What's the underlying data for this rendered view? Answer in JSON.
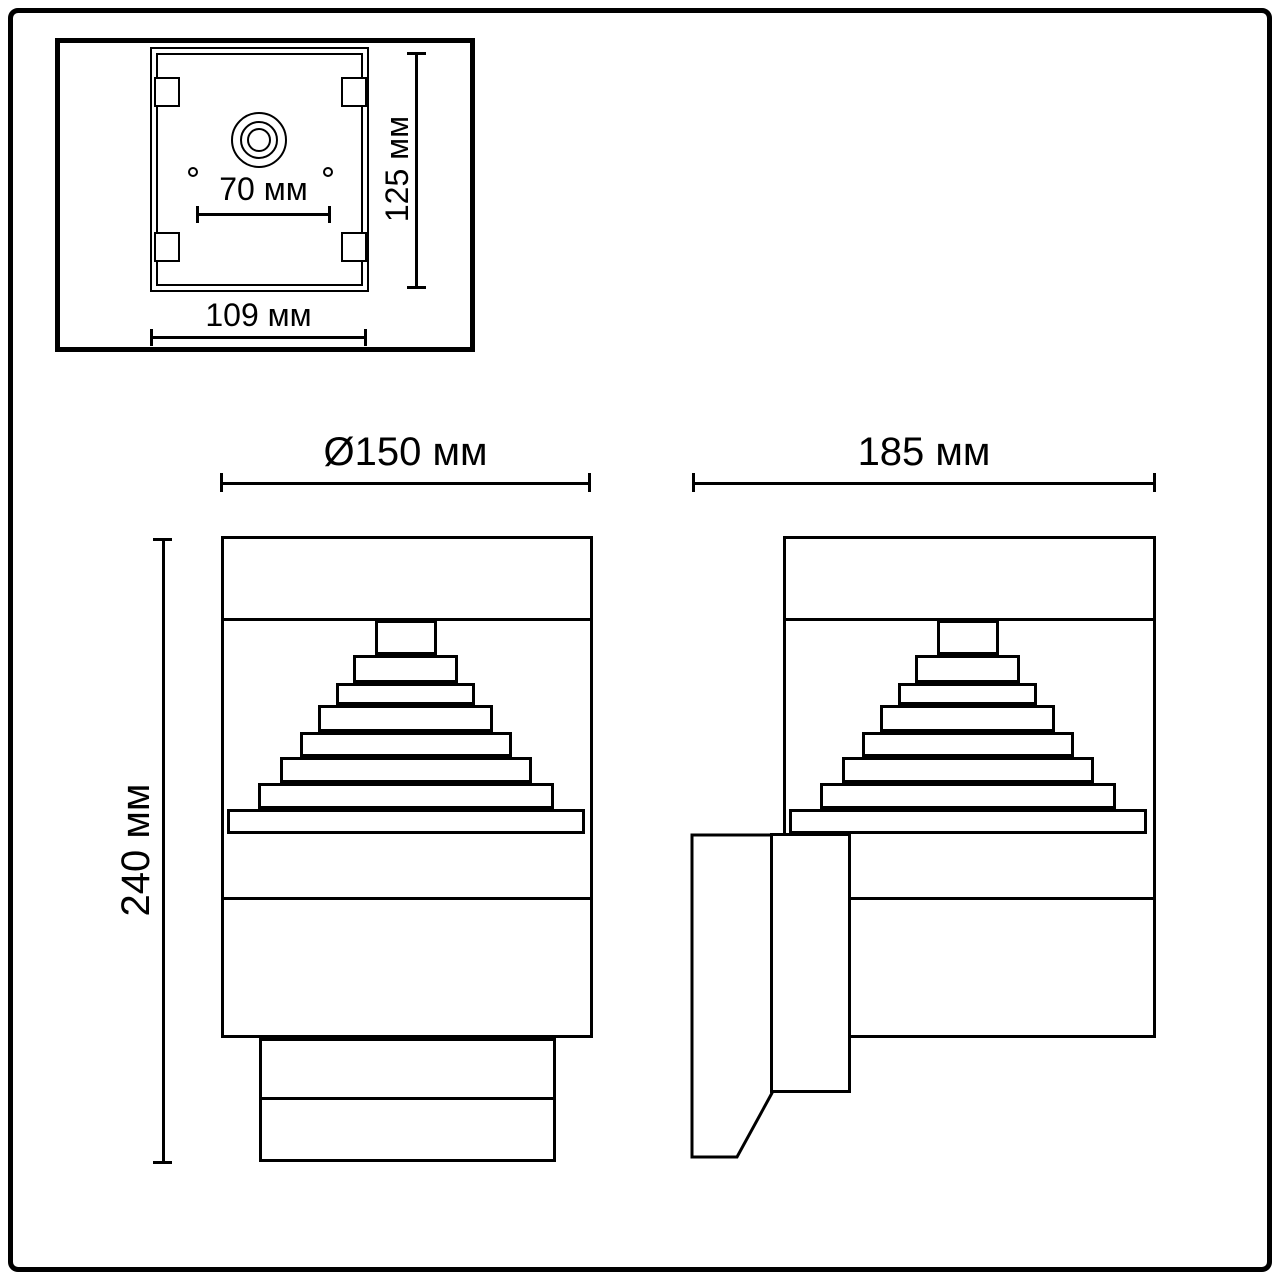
{
  "colors": {
    "background": "#ffffff",
    "line": "#000000"
  },
  "top_view": {
    "dim_hole_spacing": "70 мм",
    "dim_height": "125 мм",
    "dim_width": "109 мм"
  },
  "front_view": {
    "dim_diameter": "Ø150 мм",
    "dim_total_height": "240 мм"
  },
  "side_view": {
    "dim_depth": "185 мм"
  }
}
